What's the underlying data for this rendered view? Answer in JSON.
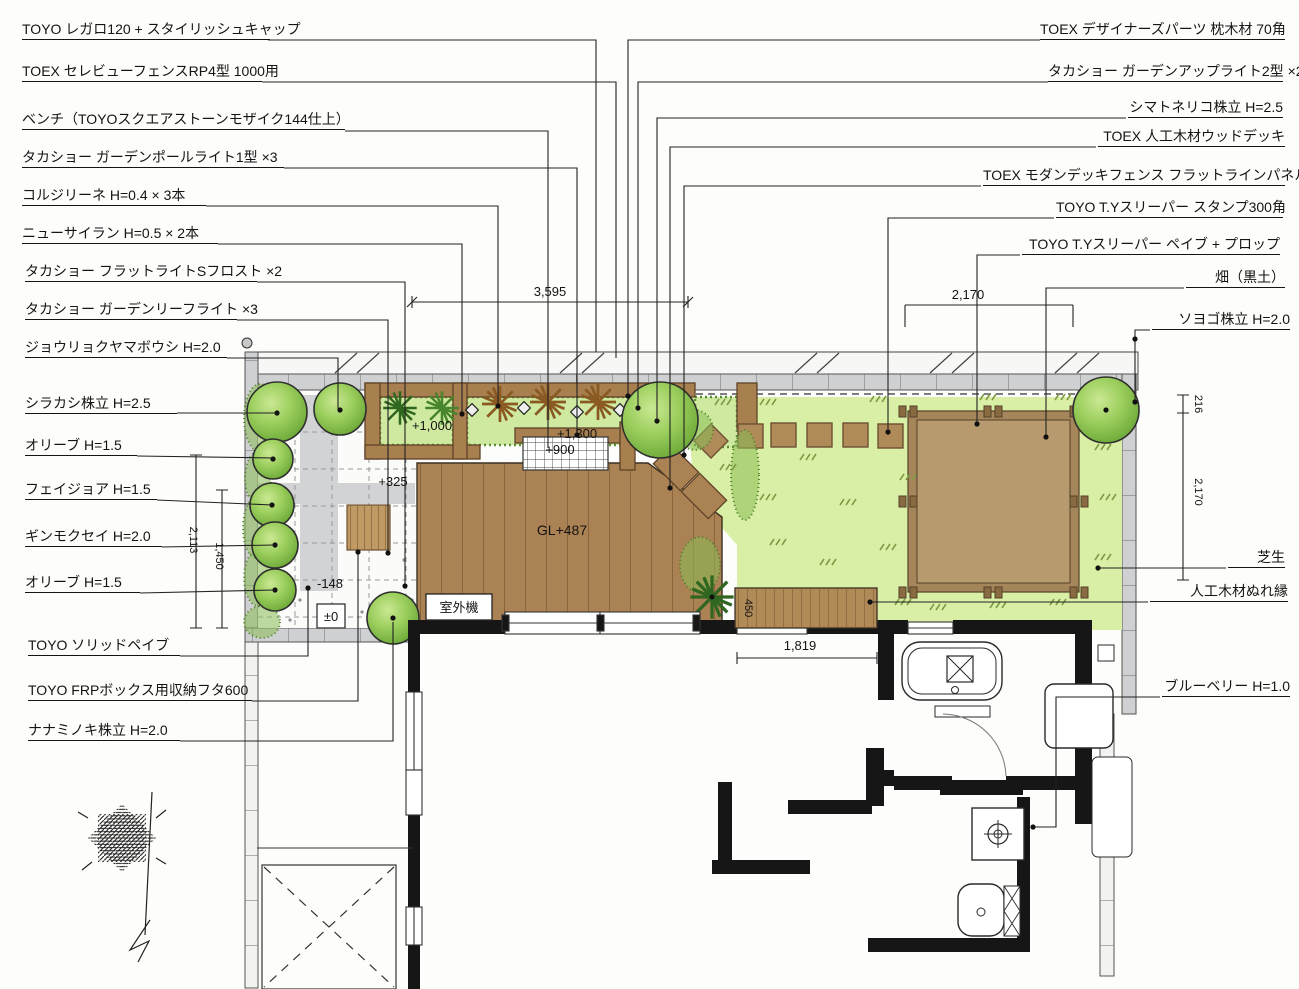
{
  "left_labels": [
    "TOYO レガロ120 + スタイリッシュキャップ",
    "TOEX セレビューフェンスRP4型 1000用",
    "ベンチ（TOYOスクエアストーンモザイク144仕上）",
    "タカショー ガーデンポールライト1型 ×3",
    "コルジリーネ H=0.4 × 3本",
    "ニューサイラン H=0.5 × 2本",
    "タカショー フラットライトSフロスト ×2",
    "タカショー ガーデンリーフライト ×3",
    "ジョウリョクヤマボウシ H=2.0",
    "シラカシ株立 H=2.5",
    "オリーブ H=1.5",
    "フェイジョア H=1.5",
    "ギンモクセイ H=2.0",
    "オリーブ H=1.5",
    "TOYO ソリッドペイブ",
    "TOYO FRPボックス用収納フタ600",
    "ナナミノキ株立 H=2.0"
  ],
  "right_labels": [
    "TOEX デザイナーズパーツ 枕木材 70角",
    "タカショー ガーデンアップライト2型 ×2",
    "シマトネリコ株立 H=2.5",
    "TOEX 人工木材ウッドデッキ",
    "TOEX モダンデッキフェンス フラットラインパネルT08",
    "TOYO T.Yスリーパー スタンプ300角",
    "TOYO T.Yスリーパー ペイブ + プロップ",
    "畑（黒土）",
    "ソヨゴ株立 H=2.0",
    "芝生",
    "人工木材ぬれ縁",
    "ブルーベリー H=1.0"
  ],
  "dimensions": {
    "garden_width": "3,595",
    "field_width": "2,170",
    "side_upper": "216",
    "side_height": "2,170",
    "terrace_height": "2,113",
    "terrace_inner_height": "1,450",
    "opening_width": "1,819",
    "veranda_depth": "450"
  },
  "levels": {
    "planter_bed": "+1,000",
    "deck_rim": "+1,300",
    "bench": "+900",
    "terrace": "+325",
    "step": "-148",
    "datum": "±0",
    "deck": "GL+487"
  },
  "equipment": {
    "outdoor_unit": "室外機"
  },
  "colors": {
    "ink": "#1f1f1f",
    "lawn": "#d9efa5",
    "foliage": "#8cc455",
    "foliage_dark": "#3f7a28",
    "deck_wood": "#ab8253",
    "deck_wood_dark": "#7b5733",
    "soil_field": "#b79a6d",
    "sleeper_border": "#a5855a",
    "paving_gray": "#d2d3d4",
    "wall_black": "#161616",
    "block_band": "#cfd0d1",
    "planter_bed_green": "#cfeaa0"
  }
}
